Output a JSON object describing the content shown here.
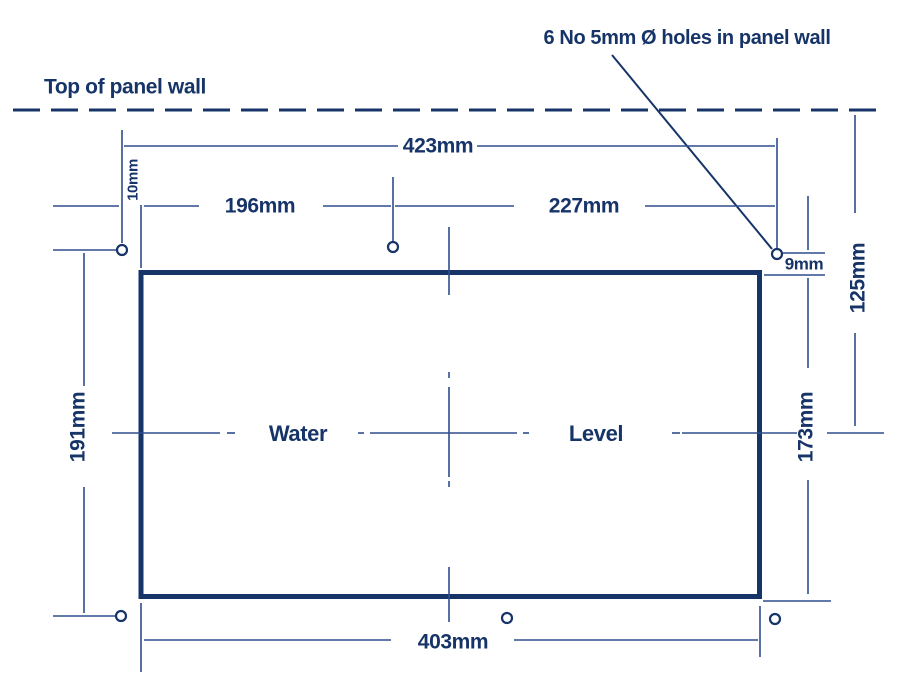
{
  "labels": {
    "holes_note": "6 No 5mm Ø holes in panel wall",
    "wall_top": "Top of panel wall",
    "panel_word_left": "Water",
    "panel_word_right": "Level"
  },
  "dimensions": {
    "hole_span_width": "423mm",
    "left_hole_to_centre_hole": "196mm",
    "centre_hole_to_right_hole": "227mm",
    "hole_to_cutout_side": "10mm",
    "hole_to_cutout_top": "9mm",
    "wall_top_to_centreline": "125mm",
    "hole_row_spacing": "191mm",
    "cutout_height": "173mm",
    "cutout_width": "403mm"
  },
  "colors": {
    "navy": "#163468",
    "dim": "#2e4d8e",
    "bg": "#ffffff"
  }
}
